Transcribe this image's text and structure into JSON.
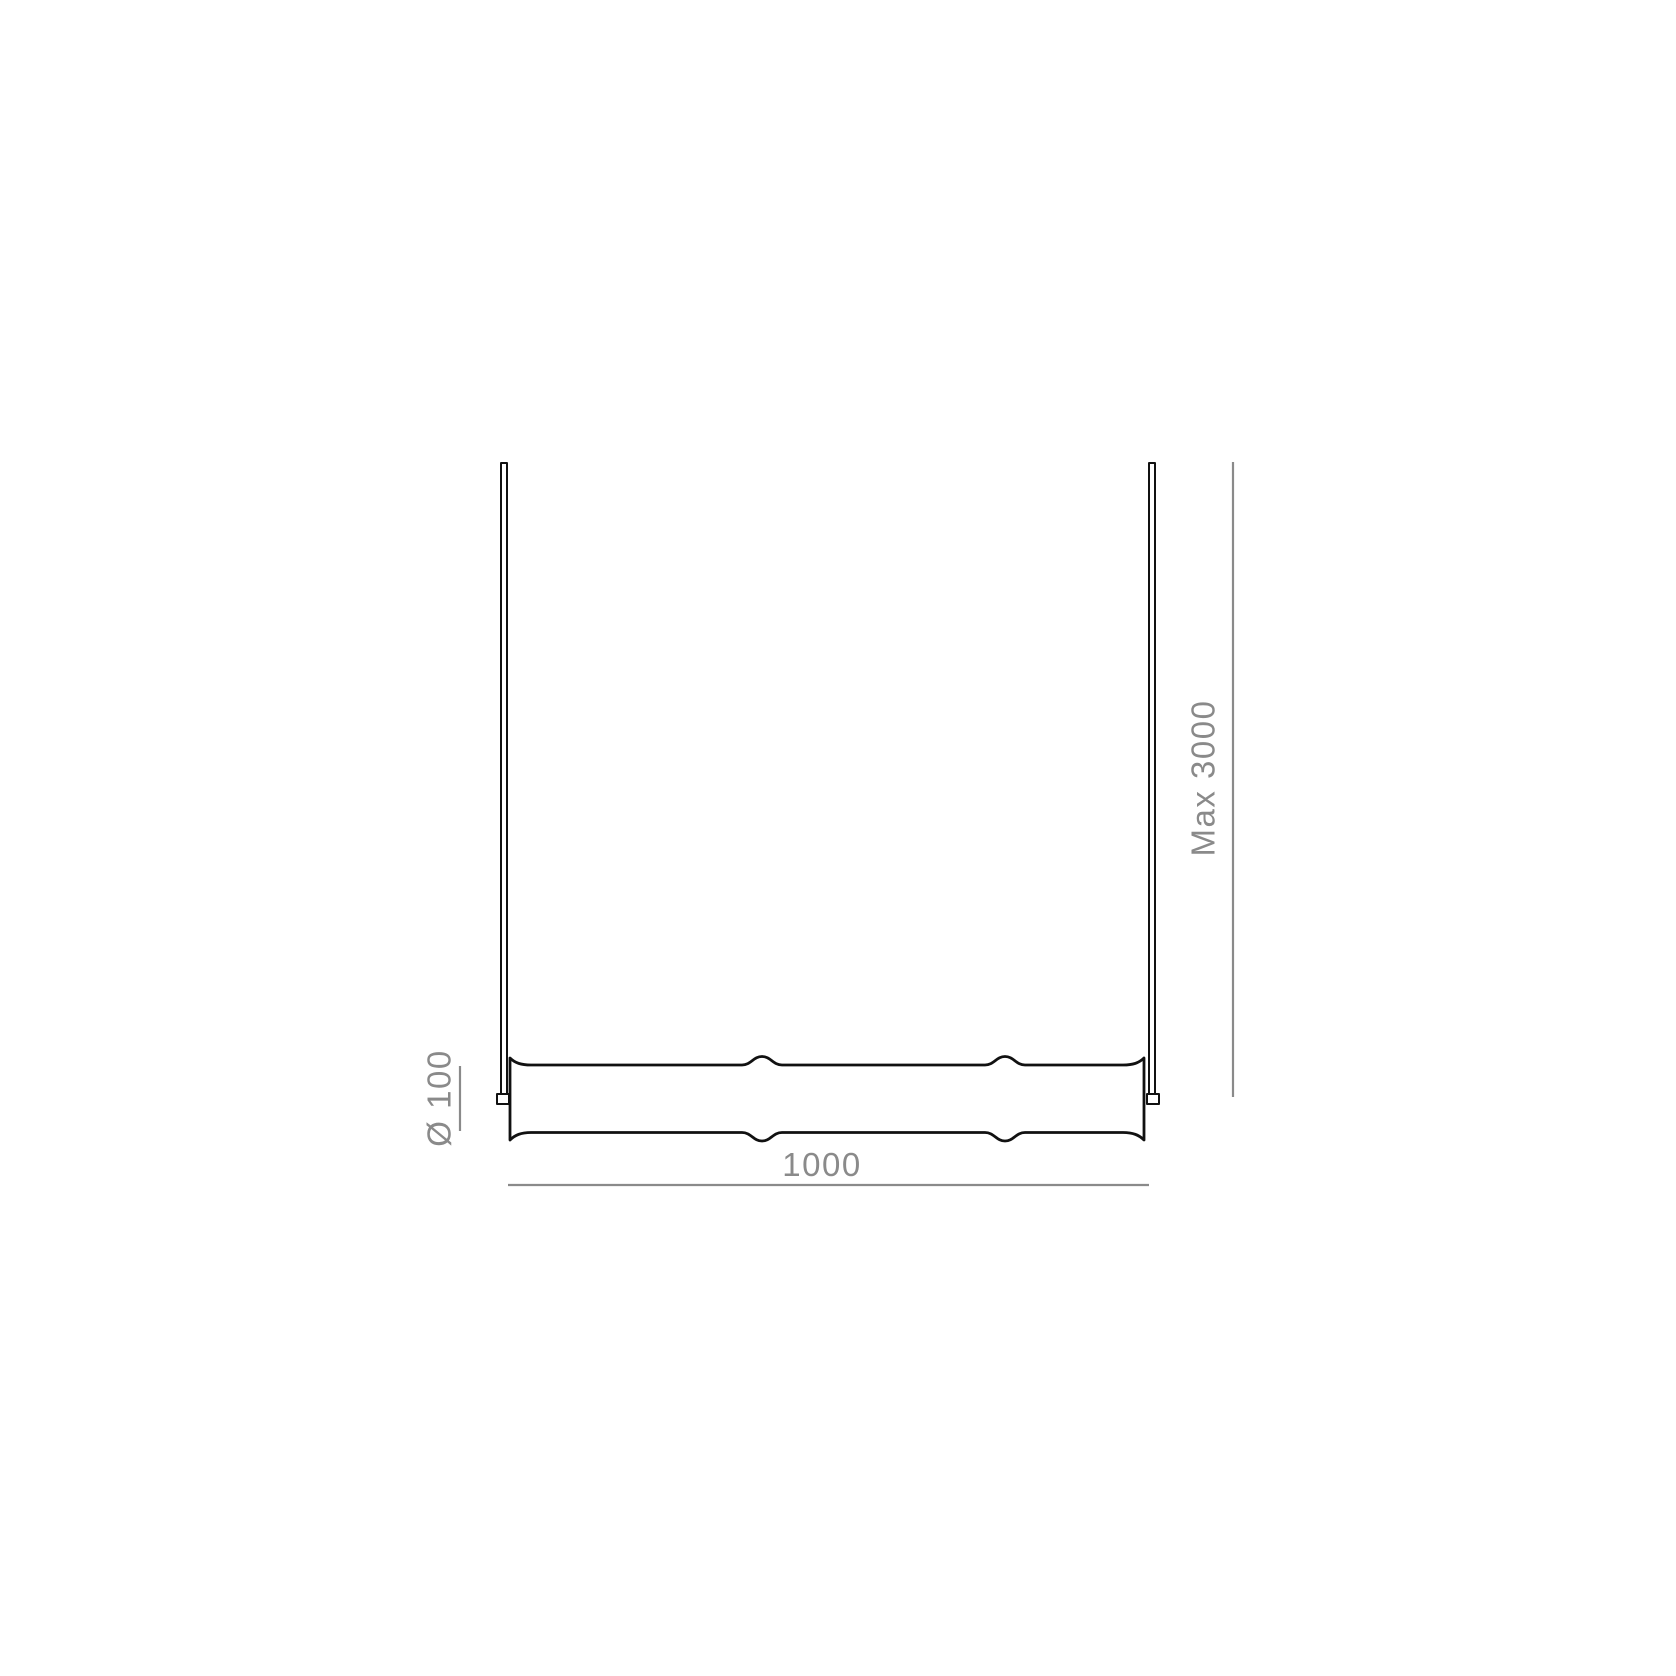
{
  "drawing": {
    "kind": "dimension-diagram",
    "labels": {
      "max_suspension": "Max 3000",
      "body_length": "1000",
      "body_diameter": "Ø 100"
    },
    "colors": {
      "outline": "#111111",
      "dimension": "#8a8a8a",
      "background": "#ffffff"
    }
  }
}
